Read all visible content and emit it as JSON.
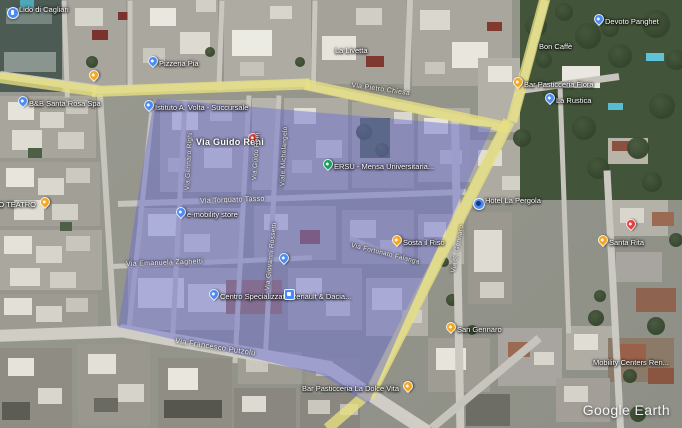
{
  "app": {
    "watermark": "Google Earth"
  },
  "colors": {
    "selection_overlay": "#6c70d2",
    "road_highlight": "#e8e080",
    "pin_blue": "#4c8bf5",
    "pin_orange": "#f5a623",
    "pin_green": "#12a05c",
    "pin_red": "#e3413a"
  },
  "pois": [
    {
      "name": "lido-di-cagliari",
      "label": "Lido di Cagliari",
      "icon": "circle",
      "color": "blue",
      "x": 12,
      "y": 12,
      "side": "right"
    },
    {
      "name": "roadside-orange-pin",
      "label": "",
      "icon": "pin",
      "color": "orange",
      "x": 93,
      "y": 80,
      "side": "right"
    },
    {
      "name": "pizzeria-pia",
      "label": "Pizzeria Pia",
      "icon": "pin",
      "color": "blue",
      "x": 152,
      "y": 66,
      "side": "right"
    },
    {
      "name": "istituto-a-volta",
      "label": "Istituto A. Volta - Succursale",
      "icon": "pin",
      "color": "blue",
      "x": 148,
      "y": 110,
      "side": "right"
    },
    {
      "name": "la-livetta",
      "label": "La Livetta",
      "icon": "none",
      "color": "blue",
      "x": 328,
      "y": 53,
      "side": "right"
    },
    {
      "name": "bon-caffe",
      "label": "Bon Caffè",
      "icon": "none",
      "color": "blue",
      "x": 532,
      "y": 49,
      "side": "right"
    },
    {
      "name": "devoto-panghet",
      "label": "Devoto Panghet",
      "icon": "pin",
      "color": "blue",
      "x": 598,
      "y": 24,
      "side": "right"
    },
    {
      "name": "bar-pasticceria-flora",
      "label": "Bar Pasticceria Flora",
      "icon": "pin",
      "color": "orange",
      "x": 517,
      "y": 87,
      "side": "right"
    },
    {
      "name": "la-rustica",
      "label": "La Rustica",
      "icon": "pin",
      "color": "blue",
      "x": 549,
      "y": 103,
      "side": "right"
    },
    {
      "name": "bb-santa-rosa-spa",
      "label": "B&B Santa Rosa Spa",
      "icon": "pin",
      "color": "blue",
      "x": 22,
      "y": 106,
      "side": "right"
    },
    {
      "name": "nuovo-teatro",
      "label": "NUOVO TEATRO",
      "icon": "pin",
      "color": "orange",
      "x": 44,
      "y": 207,
      "side": "left"
    },
    {
      "name": "street-search-marker",
      "label": "",
      "icon": "pin",
      "color": "red",
      "x": 252,
      "y": 143,
      "side": "right"
    },
    {
      "name": "ersu-mensa-universitaria",
      "label": "ERSU - Mensa Universitaria...",
      "icon": "pin",
      "color": "green",
      "x": 327,
      "y": 169,
      "side": "right"
    },
    {
      "name": "e-mobility-store",
      "label": "e-mobility store",
      "icon": "pin",
      "color": "blue",
      "x": 180,
      "y": 217,
      "side": "right"
    },
    {
      "name": "unnamed-blue-pin",
      "label": "",
      "icon": "pin",
      "color": "blue",
      "x": 283,
      "y": 263,
      "side": "right"
    },
    {
      "name": "renault-dacia-center",
      "label": "Centro Specializzato Renault & Dacia...",
      "icon": "pin",
      "color": "blue",
      "x": 213,
      "y": 299,
      "side": "right"
    },
    {
      "name": "transit-stop",
      "label": "",
      "icon": "square",
      "color": "blue",
      "x": 288,
      "y": 293,
      "side": "right"
    },
    {
      "name": "sosta-il-riso",
      "label": "Sosta il Riso",
      "icon": "pin",
      "color": "orange",
      "x": 396,
      "y": 245,
      "side": "right"
    },
    {
      "name": "san-gennaro",
      "label": "San Gennaro",
      "icon": "pin",
      "color": "orange",
      "x": 450,
      "y": 332,
      "side": "right"
    },
    {
      "name": "hotel-la-pergola",
      "label": "Hotel La Pergola",
      "icon": "photo",
      "color": "blue",
      "x": 478,
      "y": 203,
      "side": "right"
    },
    {
      "name": "unnamed-red-pin",
      "label": "",
      "icon": "pin",
      "color": "red",
      "x": 630,
      "y": 229,
      "side": "right"
    },
    {
      "name": "santa-rita",
      "label": "Santa Rita",
      "icon": "pin",
      "color": "orange",
      "x": 602,
      "y": 245,
      "side": "right"
    },
    {
      "name": "bar-pasticceria-la-dolce-vita",
      "label": "Bar Pasticceria La Dolce Vita",
      "icon": "pin",
      "color": "orange",
      "x": 407,
      "y": 391,
      "side": "left"
    },
    {
      "name": "mobility-centers",
      "label": "Mobility Centers Ren...",
      "icon": "none",
      "color": "blue",
      "x": 586,
      "y": 365,
      "side": "right"
    }
  ],
  "streets": [
    {
      "name": "via-pietro-chiesa",
      "label": "Via Pietro Chiesa",
      "x": 352,
      "y": 82,
      "rot": 8,
      "size": 7
    },
    {
      "name": "via-guido-reni-main",
      "label": "Via Guido Reni",
      "x": 196,
      "y": 137,
      "rot": 0,
      "size": 9,
      "big": true
    },
    {
      "name": "via-guido-reni-street",
      "label": "Via Guido Reni",
      "x": 251,
      "y": 180,
      "rot": -86,
      "size": 6.5
    },
    {
      "name": "viale-michelangelo",
      "label": "Viale Michelangelo",
      "x": 279,
      "y": 186,
      "rot": -87,
      "size": 6.5
    },
    {
      "name": "via-gennaro-righi",
      "label": "Via Gennaro Righi",
      "x": 184,
      "y": 190,
      "rot": -87,
      "size": 6.5
    },
    {
      "name": "via-giovanni-rossetti",
      "label": "Via Giovanni Rossetti",
      "x": 264,
      "y": 290,
      "rot": -84,
      "size": 6.5
    },
    {
      "name": "via-torquato-tasso",
      "label": "Via Torquato Tasso",
      "x": 200,
      "y": 198,
      "rot": -2,
      "size": 7
    },
    {
      "name": "via-emanuela-zaghetti",
      "label": "Via Emanuela Zaghetti",
      "x": 126,
      "y": 261,
      "rot": -2,
      "size": 7
    },
    {
      "name": "via-fortunato-falanga",
      "label": "Via Fortunato Falanga",
      "x": 352,
      "y": 242,
      "rot": 14,
      "size": 6.5
    },
    {
      "name": "via-san-gennaro",
      "label": "Via S. Gennaro",
      "x": 450,
      "y": 272,
      "rot": -80,
      "size": 6.5
    },
    {
      "name": "via-francesco-putzolu",
      "label": "Via Francesco Putzolu",
      "x": 176,
      "y": 336,
      "rot": 9,
      "size": 7.5
    }
  ]
}
